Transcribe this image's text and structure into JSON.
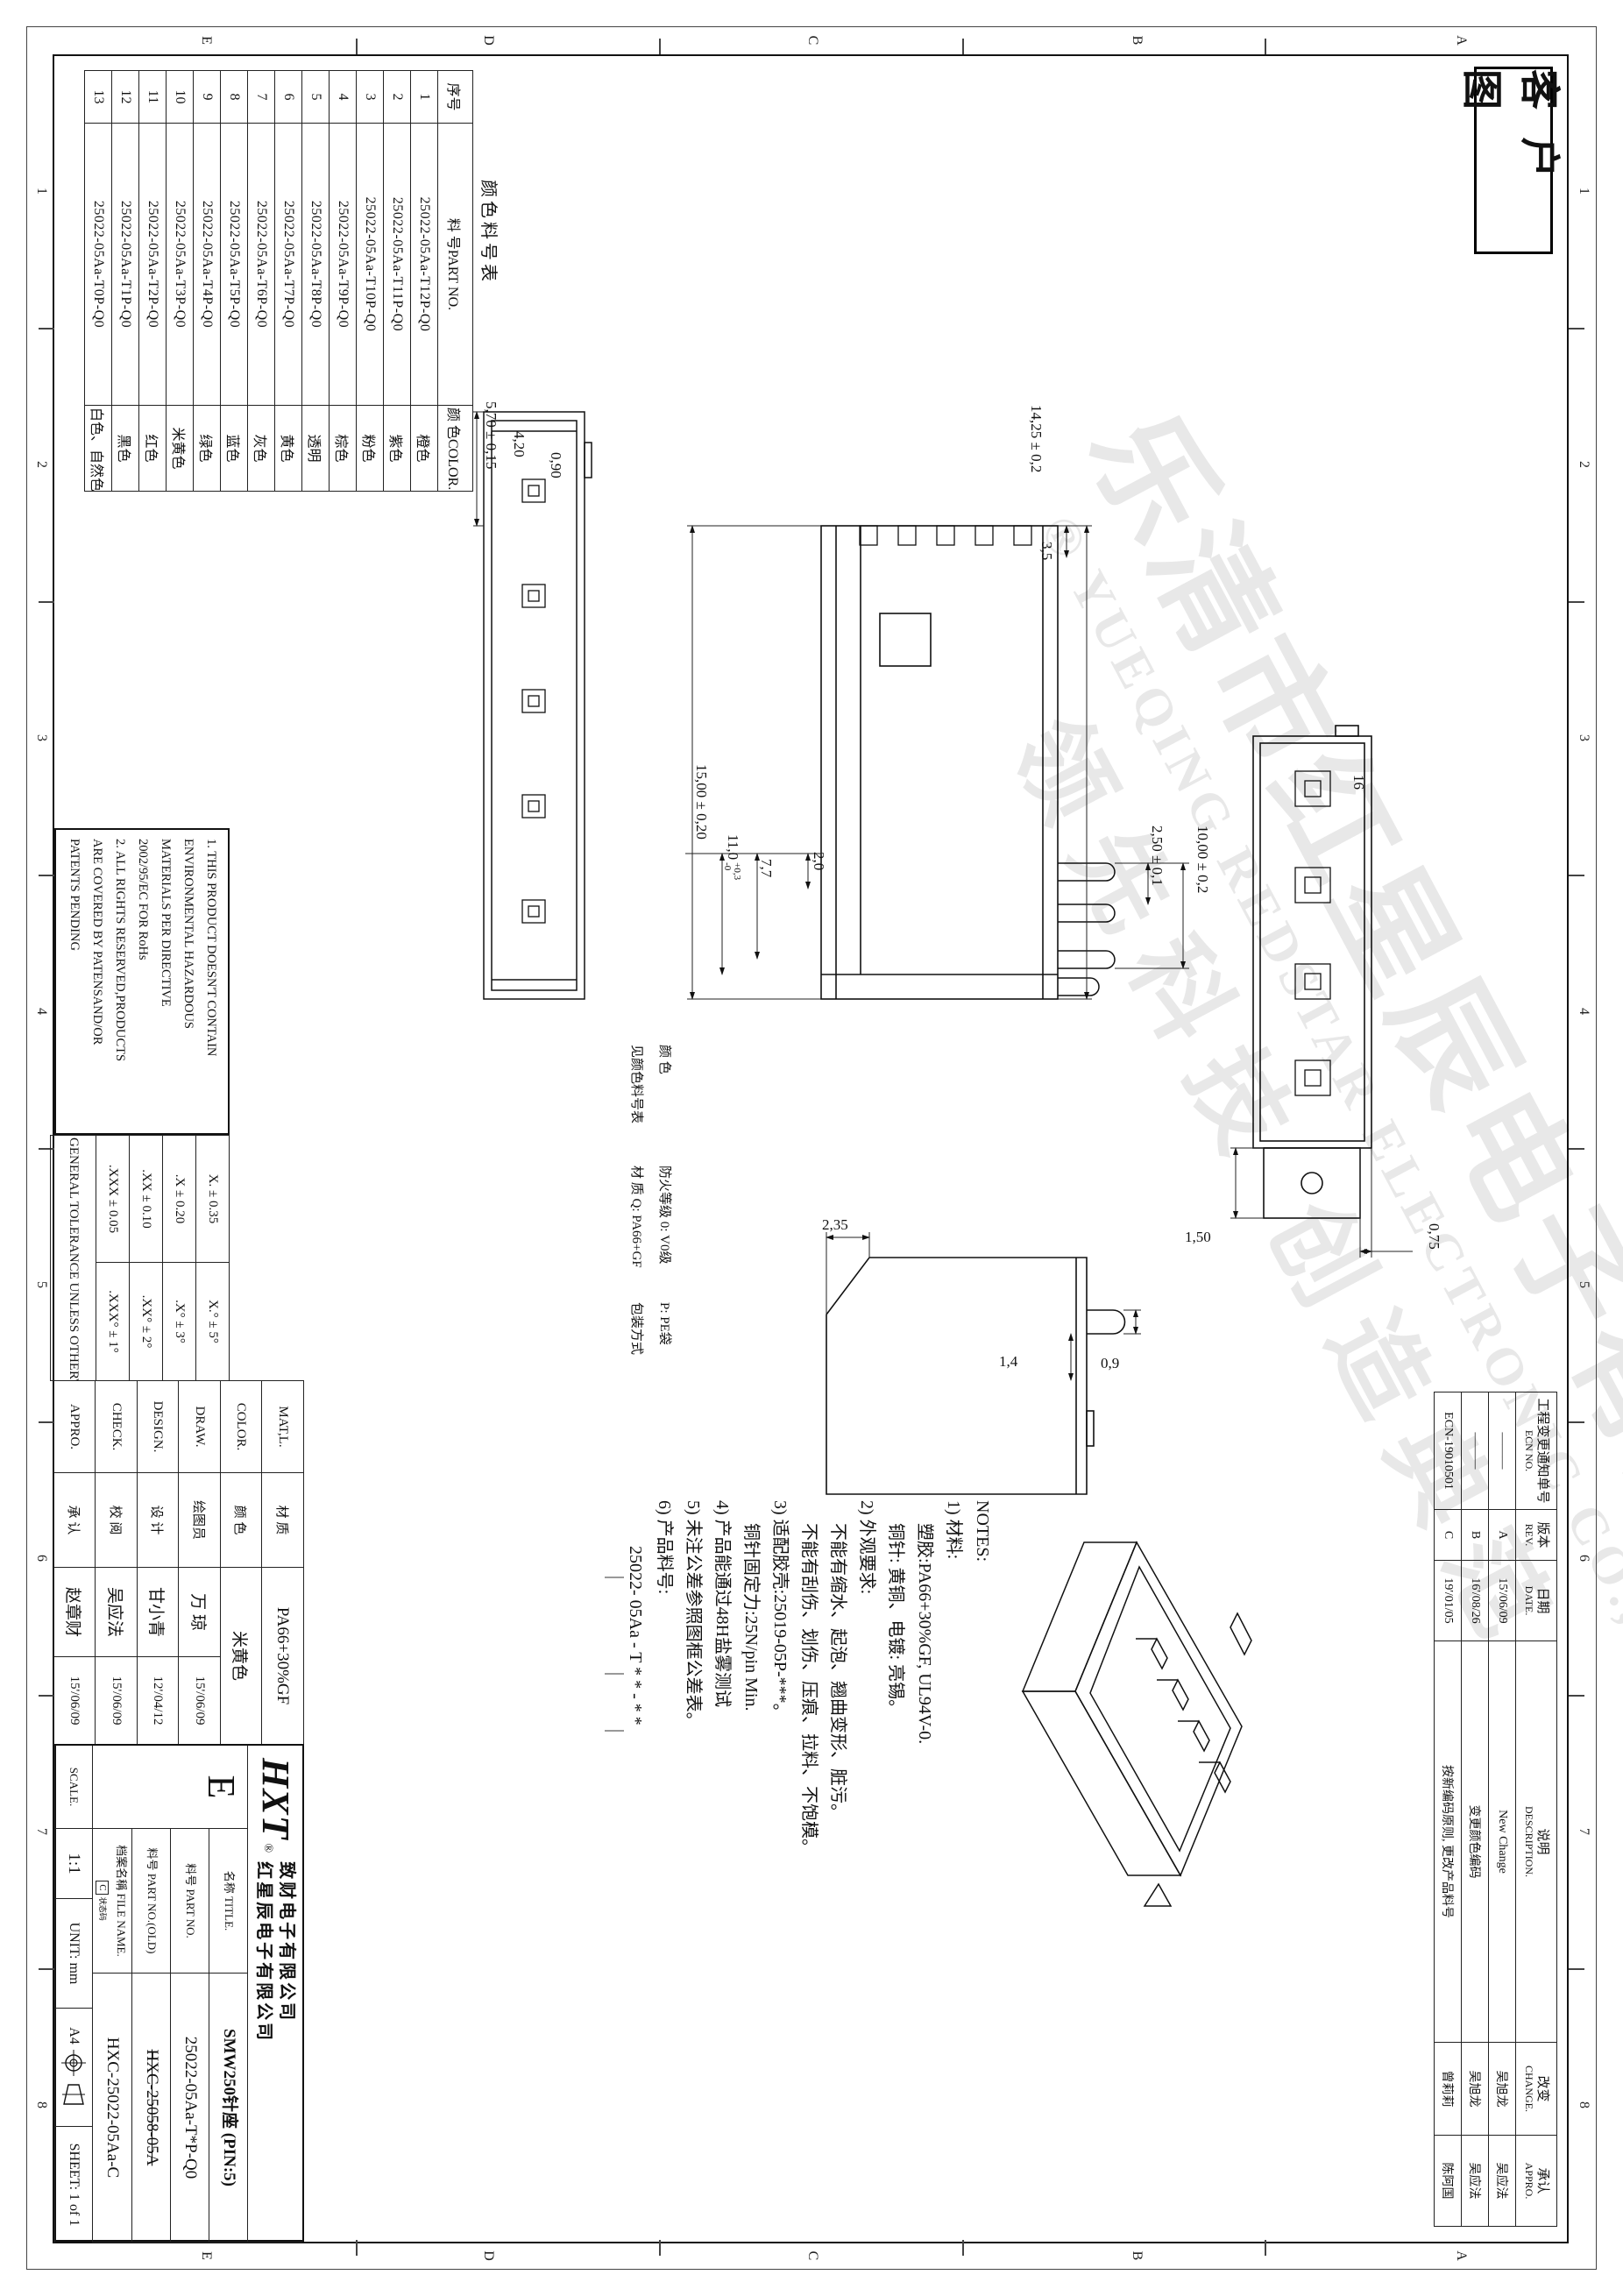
{
  "stamp": "客 户 图",
  "zones": {
    "cols": [
      "1",
      "2",
      "3",
      "4",
      "5",
      "6",
      "7",
      "8"
    ],
    "rows": [
      "A",
      "B",
      "C",
      "D",
      "E"
    ]
  },
  "watermark": {
    "line1": "乐清市红星辰电子有限公司",
    "line2": "® YUEQING REDSTAR ELECTRONIC CO.,LTD.",
    "line3": "领先科技 创造典范"
  },
  "ecn_table": {
    "headers": [
      {
        "cn": "工程变更通知单号",
        "en": "ECN NO."
      },
      {
        "cn": "版本",
        "en": "REV."
      },
      {
        "cn": "日期",
        "en": "DATE."
      },
      {
        "cn": "说明",
        "en": "DESCRIPTION."
      },
      {
        "cn": "改变",
        "en": "CHANGE."
      },
      {
        "cn": "承认",
        "en": "APPRO."
      }
    ],
    "rows": [
      {
        "ecn": "———",
        "rev": "A",
        "date": "15'/06/09",
        "desc": "New Change",
        "change": "吴旭龙",
        "appro": "吴应法"
      },
      {
        "ecn": "———",
        "rev": "B",
        "date": "16'/08/26",
        "desc": "变更颜色编码",
        "change": "吴旭龙",
        "appro": "吴应法"
      },
      {
        "ecn": "ECN-19010501",
        "rev": "C",
        "date": "19'/01/05",
        "desc": "按新编码原则, 更改产品料号",
        "change": "曾莉莉",
        "appro": "陈阿国"
      }
    ]
  },
  "color_table": {
    "title": "颜色料号表",
    "headers": [
      "序号",
      "料 号PART NO.",
      "颜 色COLOR."
    ],
    "rows": [
      {
        "no": "1",
        "part": "25022-05Aa-T12P-Q0",
        "color": "橙色"
      },
      {
        "no": "2",
        "part": "25022-05Aa-T11P-Q0",
        "color": "紫色"
      },
      {
        "no": "3",
        "part": "25022-05Aa-T10P-Q0",
        "color": "粉色"
      },
      {
        "no": "4",
        "part": "25022-05Aa-T9P-Q0",
        "color": "棕色"
      },
      {
        "no": "5",
        "part": "25022-05Aa-T8P-Q0",
        "color": "透明"
      },
      {
        "no": "6",
        "part": "25022-05Aa-T7P-Q0",
        "color": "黄色"
      },
      {
        "no": "7",
        "part": "25022-05Aa-T6P-Q0",
        "color": "灰色"
      },
      {
        "no": "8",
        "part": "25022-05Aa-T5P-Q0",
        "color": "蓝色"
      },
      {
        "no": "9",
        "part": "25022-05Aa-T4P-Q0",
        "color": "绿色"
      },
      {
        "no": "10",
        "part": "25022-05Aa-T3P-Q0",
        "color": "米黄色"
      },
      {
        "no": "11",
        "part": "25022-05Aa-T2P-Q0",
        "color": "红色"
      },
      {
        "no": "12",
        "part": "25022-05Aa-T1P-Q0",
        "color": "黑色"
      },
      {
        "no": "13",
        "part": "25022-05Aa-T0P-Q0",
        "color": "白色、自然色"
      }
    ]
  },
  "rohs_note": {
    "lines": [
      "1. THIS PRODUCT DOESN'T CONTAIN",
      "ENVIRONMENTAL HAZARDOUS",
      "MATERIALS PER DIRECTIVE",
      "2002/95/EC FOR RoHs",
      "2. ALL RIGHTS RESERVED,PRODUCTS",
      "ARE COVERED BY PATENSAND/OR",
      "PATENTS PENDING"
    ]
  },
  "tolerance_table": {
    "rows": [
      {
        "lin": "X. ± 0.35",
        "ang": "X.° ± 5°"
      },
      {
        "lin": ".X ± 0.20",
        "ang": ".X° ± 3°"
      },
      {
        "lin": ".XX ± 0.10",
        "ang": ".XX° ± 2°"
      },
      {
        "lin": ".XXX ± 0.05",
        "ang": ".XXX° ± 1°"
      }
    ],
    "footer": "GENERAL TOLERANCE UNLESS OTHERWISE NOTED"
  },
  "sign_block": {
    "rows": [
      {
        "label": "MAT,L.",
        "cn": "材 质",
        "value": "PA66+30%GF",
        "date": ""
      },
      {
        "label": "COLOR.",
        "cn": "颜 色",
        "value": "米黄色",
        "date": ""
      },
      {
        "label": "DRAW.",
        "cn": "绘图员",
        "value": "万 琼",
        "date": "15'/06/09"
      },
      {
        "label": "DESIGN.",
        "cn": "设 计",
        "value": "甘小青",
        "date": "12'/04/12"
      },
      {
        "label": "CHECK.",
        "cn": "校 阅",
        "value": "吴应法",
        "date": "15'/06/09"
      },
      {
        "label": "APPRO.",
        "cn": "承 认",
        "value": "赵章财",
        "date": "15'/06/09"
      }
    ]
  },
  "doc_block": {
    "size": "E",
    "title_label": "名称 TITLE.",
    "title": "SMW250针座  (PIN:5)",
    "part_label": "料号 PART NO.",
    "part": "25022-05Aa-T*P-Q0",
    "old_label": "料号 PART NO.(OLD)",
    "old": "HXC-25058-05A",
    "file_label": "档案名稱 FILE NAME.",
    "file_tag": "C",
    "file_tag2": "状态码",
    "file": "HXC-25022-05Aa-C",
    "scale_label": "SCALE.",
    "scale": "1:1",
    "unit": "UNIT: mm",
    "paper": "A4",
    "sheet": "SHEET: 1 of 1"
  },
  "logo": {
    "brand": "HXT",
    "reg": "®",
    "line1": "致财电子有限公司",
    "line2": "红星辰电子有限公司"
  },
  "notes": {
    "lines": [
      "NOTES:",
      "1) 材料:",
      "塑胶:PA66+30%GF, UL94V-0.",
      "铜针: 黄铜、电镀: 亮锡。",
      "2) 外观要求:",
      "不能有缩水、起泡、翘曲变形、脏污。",
      "不能有刮伤、划伤、压痕、拉料、不饱模。",
      "3) 适配胶壳:25019-05P-***。",
      "铜针固定力:25N/pin Min.",
      "4) 产品能通过48H盐雾测试",
      "5) 未注公差参照图框公差表。",
      "6) 产品料号:",
      "25022- 05Aa - T * * - * *"
    ]
  },
  "annotations": {
    "color_lbl": "颜 色",
    "color_ref": "见颜色料号表",
    "fire_lbl": "防火等级 0: V0级",
    "mat_lbl": "材 质 Q: PA66+GF",
    "pack_val": "P: PE袋",
    "pack_lbl": "包装方式"
  },
  "dims": {
    "d570": "5,70 ± 0,15",
    "d420": "4,20",
    "d090": "0,90",
    "d1425": "14,25 ± 0,2",
    "d35": "3,5",
    "d250": "2,50 ± 0,1",
    "d1000": "10,00 ± 0,2",
    "d20": "2,0",
    "d77": "7,7",
    "d110": "11,0",
    "d110up": "+0,3",
    "d110dn": "-0",
    "d1500": "15,00 ± 0,20",
    "d16": "16",
    "d075": "0,75",
    "d150": "1,50",
    "d235": "2,35",
    "d09": "0,9",
    "d14": "1,4"
  }
}
